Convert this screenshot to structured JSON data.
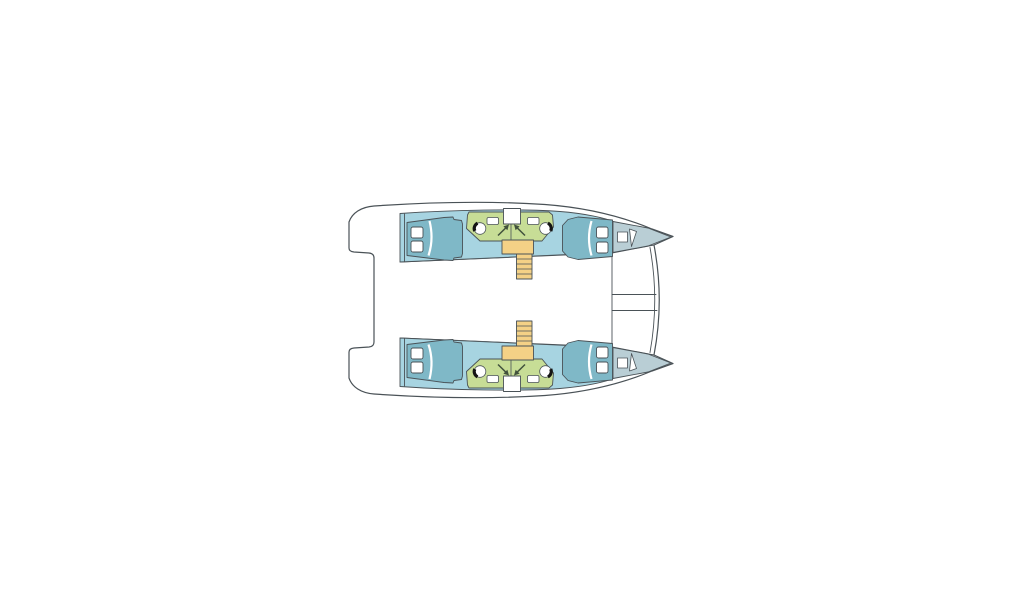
{
  "diagram": {
    "type": "catamaran-floor-plan",
    "view": "top-down deck layout, bow pointing right",
    "colors": {
      "background": "#ffffff",
      "outline": "#4a5257",
      "deck": "#ffffff",
      "cabin_floor": "#a7d4e1",
      "berth": "#7fb8c7",
      "bow_locker": "#b9ced5",
      "head_compartment": "#c7dd96",
      "stairs": "#f4d186",
      "fixture": "#ffffff",
      "arrow": "#42523d",
      "toilet_mark": "#141414"
    },
    "components": {
      "hulls": [
        {
          "id": "port-hull",
          "position": "top",
          "parts": [
            "aft-double-berth",
            "head-compartment",
            "companionway-stairs",
            "forward-double-berth",
            "bow-locker"
          ]
        },
        {
          "id": "starboard-hull",
          "position": "bottom",
          "parts": [
            "aft-double-berth",
            "head-compartment",
            "companionway-stairs",
            "forward-double-berth",
            "bow-locker"
          ]
        }
      ],
      "per_hull_fixtures": {
        "toilets": 2,
        "sinks": 2,
        "deck_hatches": 2,
        "pillows_per_berth": 2,
        "stair_treads": 5,
        "entry_arrows": 2
      },
      "shared": [
        "bridgedeck-salon-area",
        "forward-trampoline",
        "forward-crossbeam",
        "stern-transoms"
      ]
    }
  }
}
